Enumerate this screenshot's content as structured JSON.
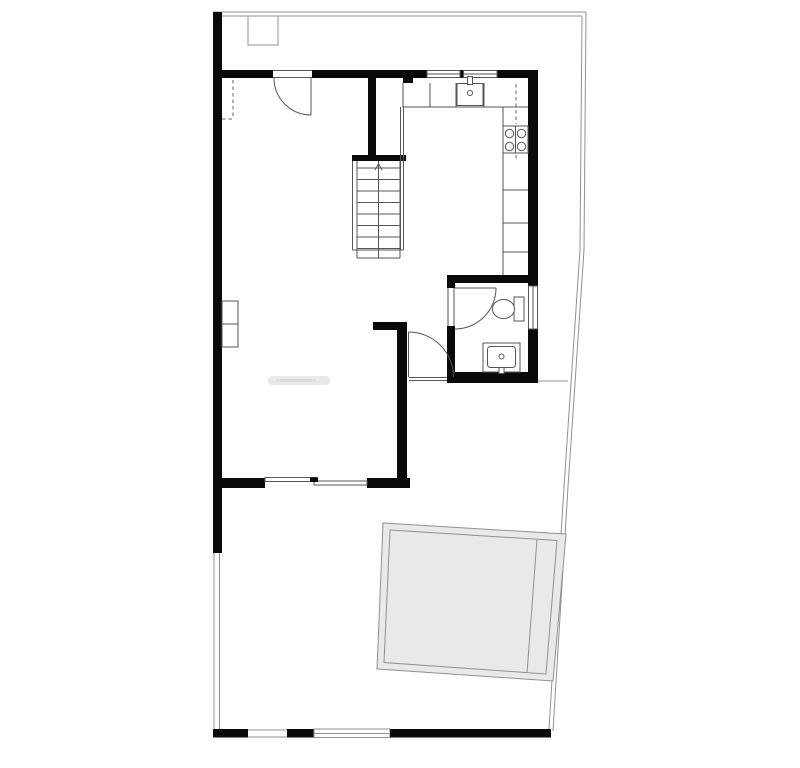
{
  "plan": {
    "background": "#ffffff",
    "colors": {
      "background": "#ffffff",
      "wall": "#0a0a0a",
      "line": "#555555",
      "line_light": "#909090",
      "dash": "#666666",
      "terrace_fill": "#e9e9e9",
      "smudge": "#c6c6c6"
    },
    "drawing_type": "architectural floor plan, ground floor",
    "stair_direction": "up",
    "fixtures": [
      "property-boundary",
      "utility-meter-box",
      "entry-door",
      "wardrobe-dashed-outline",
      "kitchen-counter",
      "kitchen-sink",
      "cooktop-4-burners",
      "upper-cabinet-dashed-line",
      "staircase",
      "stair-railing",
      "bathroom-door",
      "toilet",
      "washbasin",
      "bathroom-window",
      "kitchen-windows",
      "radiator",
      "hall-door",
      "sliding-patio-door",
      "terrace-pad",
      "rear-fence-gate",
      "rear-fence-panel",
      "faint-label-smudge"
    ]
  }
}
